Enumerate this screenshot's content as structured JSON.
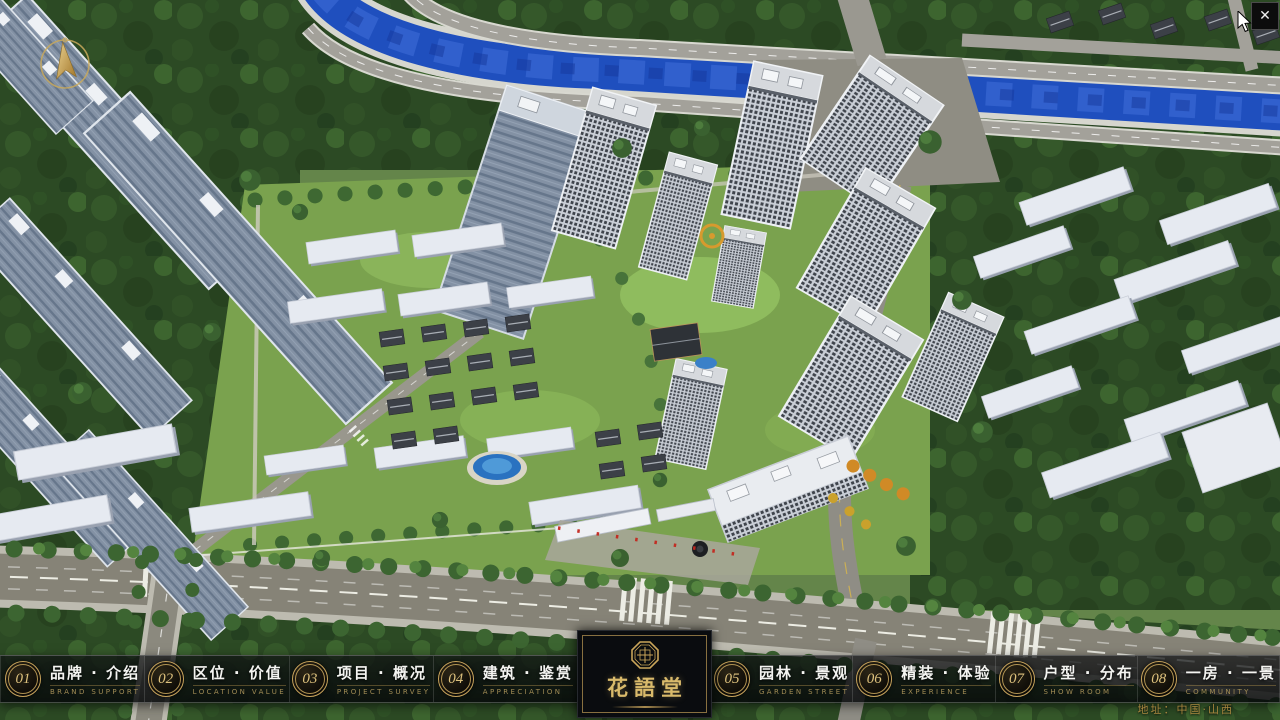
{
  "window": {
    "close_glyph": "✕"
  },
  "nav": {
    "items": [
      {
        "num": "01",
        "label": "品牌 · 介绍",
        "caption": "BRAND SUPPORT"
      },
      {
        "num": "02",
        "label": "区位 · 价值",
        "caption": "LOCATION VALUE"
      },
      {
        "num": "03",
        "label": "项目 · 概况",
        "caption": "PROJECT SURVEY"
      },
      {
        "num": "04",
        "label": "建筑 · 鉴赏",
        "caption": "APPRECIATION"
      },
      {
        "num": "05",
        "label": "园林 · 景观",
        "caption": "GARDEN STREET"
      },
      {
        "num": "06",
        "label": "精装 · 体验",
        "caption": "EXPERIENCE"
      },
      {
        "num": "07",
        "label": "户型 · 分布",
        "caption": "SHOW ROOM"
      },
      {
        "num": "08",
        "label": "一房 · 一景",
        "caption": "COMMUNITY"
      }
    ]
  },
  "logo": {
    "name": "花語堂"
  },
  "footer": {
    "address": "地址：中国·山西"
  },
  "colors": {
    "gold": "#c8a45c",
    "river": "#1f4fbe",
    "bar_bg": "rgba(8,10,12,0.78)"
  }
}
